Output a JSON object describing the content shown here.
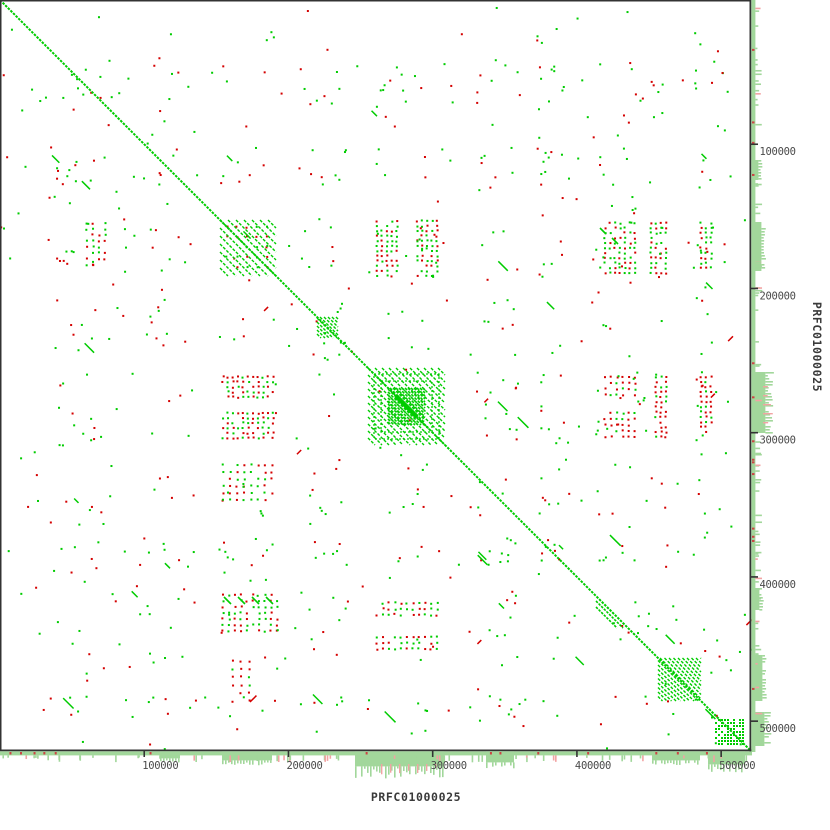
{
  "chart_data": {
    "type": "dotplot",
    "title": "",
    "x_sequence": "PRFC01000025",
    "y_sequence": "PRFC01000025",
    "sequence_length_bp": 520000,
    "x_axis": {
      "ticks": [
        {
          "bp": 100000,
          "label": "100000"
        },
        {
          "bp": 200000,
          "label": "200000"
        },
        {
          "bp": 300000,
          "label": "300000"
        },
        {
          "bp": 400000,
          "label": "400000"
        },
        {
          "bp": 500000,
          "label": "500000"
        }
      ]
    },
    "y_axis": {
      "ticks": [
        {
          "bp": 100000,
          "label": "100000"
        },
        {
          "bp": 200000,
          "label": "200000"
        },
        {
          "bp": 300000,
          "label": "300000"
        },
        {
          "bp": 400000,
          "label": "400000"
        },
        {
          "bp": 500000,
          "label": "500000"
        }
      ]
    },
    "layout": {
      "page_px": 830,
      "plot_px": 750
    },
    "colors": {
      "forward": "#00cc00",
      "reverse": "#d40000",
      "hist_green": "#a2d79b",
      "hist_red": "#f2a3a3",
      "red_tick": "#cc4444",
      "axis": "#333333",
      "tick_text": "#4a4a4a",
      "label_text": "#3a3a3a",
      "background": "#ffffff"
    },
    "features": {
      "diagonal": {
        "from_bp": 0,
        "to_bp": 520000,
        "dash": "2.5,1.2",
        "width": 2
      },
      "blocks": [
        {
          "style": "hatch",
          "x": 220,
          "y": 220,
          "size": 56,
          "gap": 8
        },
        {
          "style": "hatch",
          "x": 317,
          "y": 317,
          "size": 21,
          "gap": 4
        },
        {
          "style": "tandem",
          "x": 368,
          "y": 368,
          "size": 77
        },
        {
          "style": "lines",
          "x": 596,
          "y": 596,
          "size": 32,
          "offsets": [
            5,
            11
          ]
        },
        {
          "style": "hatch",
          "x": 658,
          "y": 658,
          "size": 43,
          "gap": 4.5
        },
        {
          "style": "checker",
          "x": 715,
          "y": 719,
          "w": 28,
          "h": 25
        }
      ],
      "clusters": [
        {
          "x": 376,
          "y": 220,
          "w": 20,
          "h": 56,
          "gap": 5,
          "green": 0.55
        },
        {
          "x": 416,
          "y": 220,
          "w": 24,
          "h": 56,
          "gap": 5,
          "green": 0.5
        },
        {
          "x": 222,
          "y": 376,
          "w": 52,
          "h": 20,
          "gap": 5,
          "green": 0.5
        },
        {
          "x": 222,
          "y": 412,
          "w": 52,
          "h": 26,
          "gap": 5,
          "green": 0.45
        },
        {
          "x": 604,
          "y": 222,
          "w": 30,
          "h": 50,
          "gap": 5,
          "green": 0.6
        },
        {
          "x": 650,
          "y": 222,
          "w": 16,
          "h": 50,
          "gap": 5,
          "green": 0.6
        },
        {
          "x": 604,
          "y": 376,
          "w": 30,
          "h": 20,
          "gap": 6,
          "green": 0.15
        },
        {
          "x": 604,
          "y": 412,
          "w": 30,
          "h": 28,
          "gap": 6,
          "green": 0.2
        },
        {
          "x": 655,
          "y": 376,
          "w": 12,
          "h": 62,
          "gap": 5,
          "green": 0.2
        },
        {
          "x": 376,
          "y": 602,
          "w": 64,
          "h": 16,
          "gap": 6,
          "green": 0.5
        },
        {
          "x": 376,
          "y": 636,
          "w": 64,
          "h": 14,
          "gap": 6,
          "green": 0.4
        },
        {
          "x": 222,
          "y": 594,
          "w": 54,
          "h": 40,
          "gap": 6,
          "green": 0.55
        },
        {
          "x": 232,
          "y": 660,
          "w": 20,
          "h": 42,
          "gap": 8,
          "green": 0.1
        },
        {
          "x": 222,
          "y": 464,
          "w": 52,
          "h": 40,
          "gap": 7,
          "green": 0.6
        },
        {
          "x": 700,
          "y": 222,
          "w": 12,
          "h": 48,
          "gap": 5,
          "green": 0.6
        },
        {
          "x": 700,
          "y": 376,
          "w": 12,
          "h": 58,
          "gap": 5,
          "green": 0.3
        },
        {
          "x": 86,
          "y": 222,
          "w": 20,
          "h": 46,
          "gap": 6,
          "green": 0.5
        },
        {
          "x": 226,
          "y": 226,
          "w": 46,
          "h": 46,
          "gap": 10,
          "green": 0.3
        }
      ],
      "dashes": [
        {
          "x": 224,
          "y": 597,
          "len": 7
        },
        {
          "x": 238,
          "y": 597,
          "len": 7
        },
        {
          "x": 252,
          "y": 597,
          "len": 7
        },
        {
          "x": 266,
          "y": 597,
          "len": 7
        },
        {
          "x": 600,
          "y": 228,
          "len": 6
        },
        {
          "x": 612,
          "y": 238,
          "len": 6
        }
      ],
      "scatter": {
        "seed": 1337,
        "green": 520,
        "red": 260,
        "band_prob": 0.5,
        "bands": [
          [
            56,
            104
          ],
          [
            146,
            184
          ],
          [
            218,
            276
          ],
          [
            298,
            346
          ],
          [
            370,
            448
          ],
          [
            476,
            518
          ],
          [
            536,
            564
          ],
          [
            590,
            668
          ],
          [
            694,
            718
          ]
        ],
        "random_dashes_green": 26,
        "random_dashes_red": 8
      }
    },
    "histograms": {
      "band_px": 4,
      "bottom": {
        "blocks": [
          {
            "x0": 355,
            "x1": 444,
            "base": 11,
            "comb": 11,
            "red": true
          },
          {
            "x0": 222,
            "x1": 272,
            "base": 5,
            "comb": 3
          },
          {
            "x0": 486,
            "x1": 514,
            "base": 7,
            "comb": 4
          },
          {
            "x0": 652,
            "x1": 700,
            "base": 5,
            "comb": 3
          },
          {
            "x0": 708,
            "x1": 745,
            "base": 9,
            "comb": 7
          },
          {
            "x0": 160,
            "x1": 180,
            "base": 3,
            "comb": 2
          }
        ],
        "scatter_bars": 85,
        "red_ticks": 14
      },
      "right": {
        "blocks": [
          {
            "y0": 372,
            "y1": 433,
            "base": 10,
            "comb": 8,
            "red": true
          },
          {
            "y0": 222,
            "y1": 271,
            "base": 6,
            "comb": 3
          },
          {
            "y0": 655,
            "y1": 701,
            "base": 7,
            "comb": 4
          },
          {
            "y0": 712,
            "y1": 746,
            "base": 9,
            "comb": 5
          },
          {
            "y0": 588,
            "y1": 610,
            "base": 4,
            "comb": 3
          },
          {
            "y0": 160,
            "y1": 180,
            "base": 3,
            "comb": 2
          }
        ],
        "scatter_bars": 85,
        "red_ticks": 14
      }
    }
  }
}
